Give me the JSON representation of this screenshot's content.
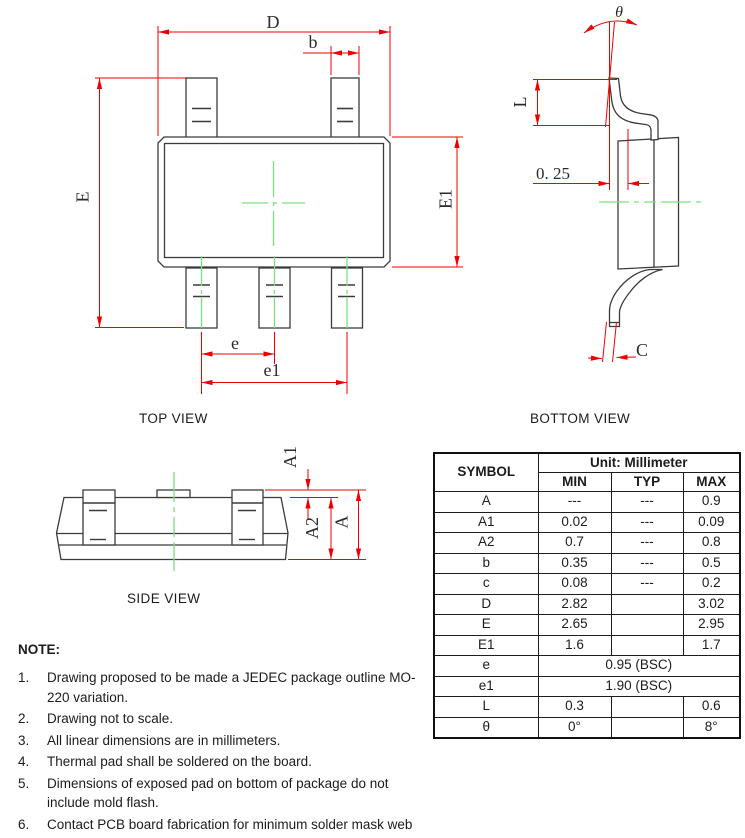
{
  "views": {
    "top": {
      "title": "TOP VIEW",
      "labels": {
        "D": "D",
        "b": "b",
        "E": "E",
        "E1": "E1",
        "e": "e",
        "e1": "e1"
      }
    },
    "bottom": {
      "title": "BOTTOM VIEW",
      "labels": {
        "theta": "θ",
        "L": "L",
        "offset": "0. 25",
        "C": "C"
      }
    },
    "side": {
      "title": "SIDE VIEW",
      "labels": {
        "A1": "A1",
        "A2": "A2",
        "A": "A"
      }
    }
  },
  "table": {
    "symbol_header": "SYMBOL",
    "unit_header": "Unit: Millimeter",
    "columns": [
      "MIN",
      "TYP",
      "MAX"
    ],
    "rows": [
      {
        "symbol": "A",
        "min": "---",
        "typ": "---",
        "max": "0.9"
      },
      {
        "symbol": "A1",
        "min": "0.02",
        "typ": "---",
        "max": "0.09"
      },
      {
        "symbol": "A2",
        "min": "0.7",
        "typ": "---",
        "max": "0.8"
      },
      {
        "symbol": "b",
        "min": "0.35",
        "typ": "---",
        "max": "0.5"
      },
      {
        "symbol": "c",
        "min": "0.08",
        "typ": "---",
        "max": "0.2"
      },
      {
        "symbol": "D",
        "min": "2.82",
        "typ": "",
        "max": "3.02"
      },
      {
        "symbol": "E",
        "min": "2.65",
        "typ": "",
        "max": "2.95"
      },
      {
        "symbol": "E1",
        "min": "1.6",
        "typ": "",
        "max": "1.7"
      },
      {
        "symbol": "e",
        "span": "0.95 (BSC)"
      },
      {
        "symbol": "e1",
        "span": "1.90 (BSC)"
      },
      {
        "symbol": "L",
        "min": "0.3",
        "typ": "",
        "max": "0.6"
      },
      {
        "symbol": "θ",
        "min": "0°",
        "typ": "",
        "max": "8°"
      }
    ]
  },
  "notes": {
    "heading": "NOTE:",
    "items": [
      "Drawing proposed to be made a JEDEC package outline MO-220 variation.",
      "Drawing not to scale.",
      "All linear dimensions are in millimeters.",
      "Thermal pad shall be soldered on the board.",
      "Dimensions of exposed pad on bottom of package do not include mold flash.",
      "Contact PCB board fabrication for minimum solder mask web tolerances between the pins."
    ]
  },
  "colors": {
    "dimension_red": "#ee0000",
    "centerline_green": "#7fdd7f",
    "outline_gray": "#3b3b3b"
  }
}
